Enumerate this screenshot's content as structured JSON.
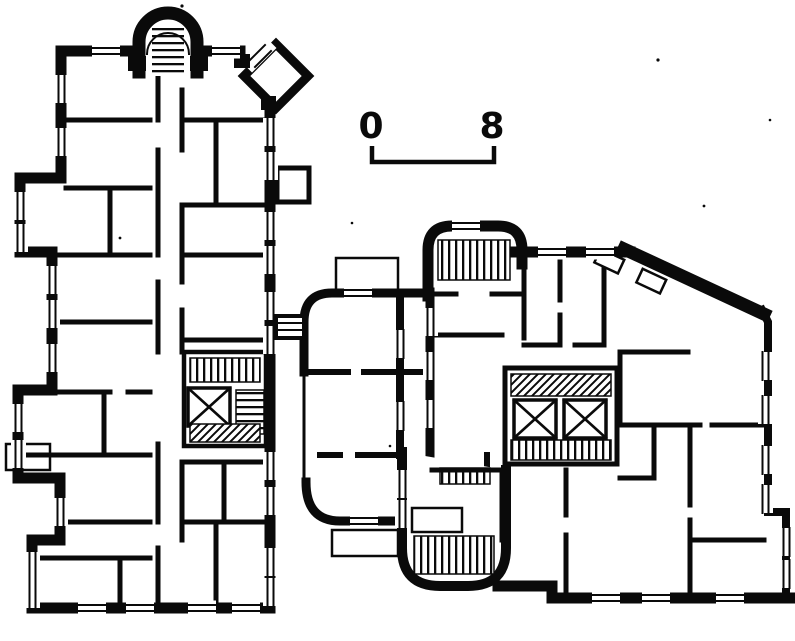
{
  "document": {
    "kind": "architectural floor plan (scanned line drawing)",
    "wings": [
      {
        "name": "west wing",
        "description": "tall vertical slab with arched stair tower at top, diagonal corner bay, stair core with elevator"
      },
      {
        "name": "east wing",
        "description": "slab with diagonal north-east wall, rounded stair bays, double elevator core"
      },
      {
        "name": "connector",
        "description": "rounded-corner rooms joining the two wings"
      }
    ],
    "features": [
      "arched-stair-tower",
      "diagonal-corner-bay",
      "stair-flight-hatching",
      "elevator-x-shaft",
      "window-openings-in-poche-walls",
      "scale-bar"
    ]
  },
  "palette": {
    "ink": "#0a0a0a",
    "paper": "#ffffff"
  },
  "scale_bar": {
    "start_label": "0",
    "end_label": "8"
  }
}
